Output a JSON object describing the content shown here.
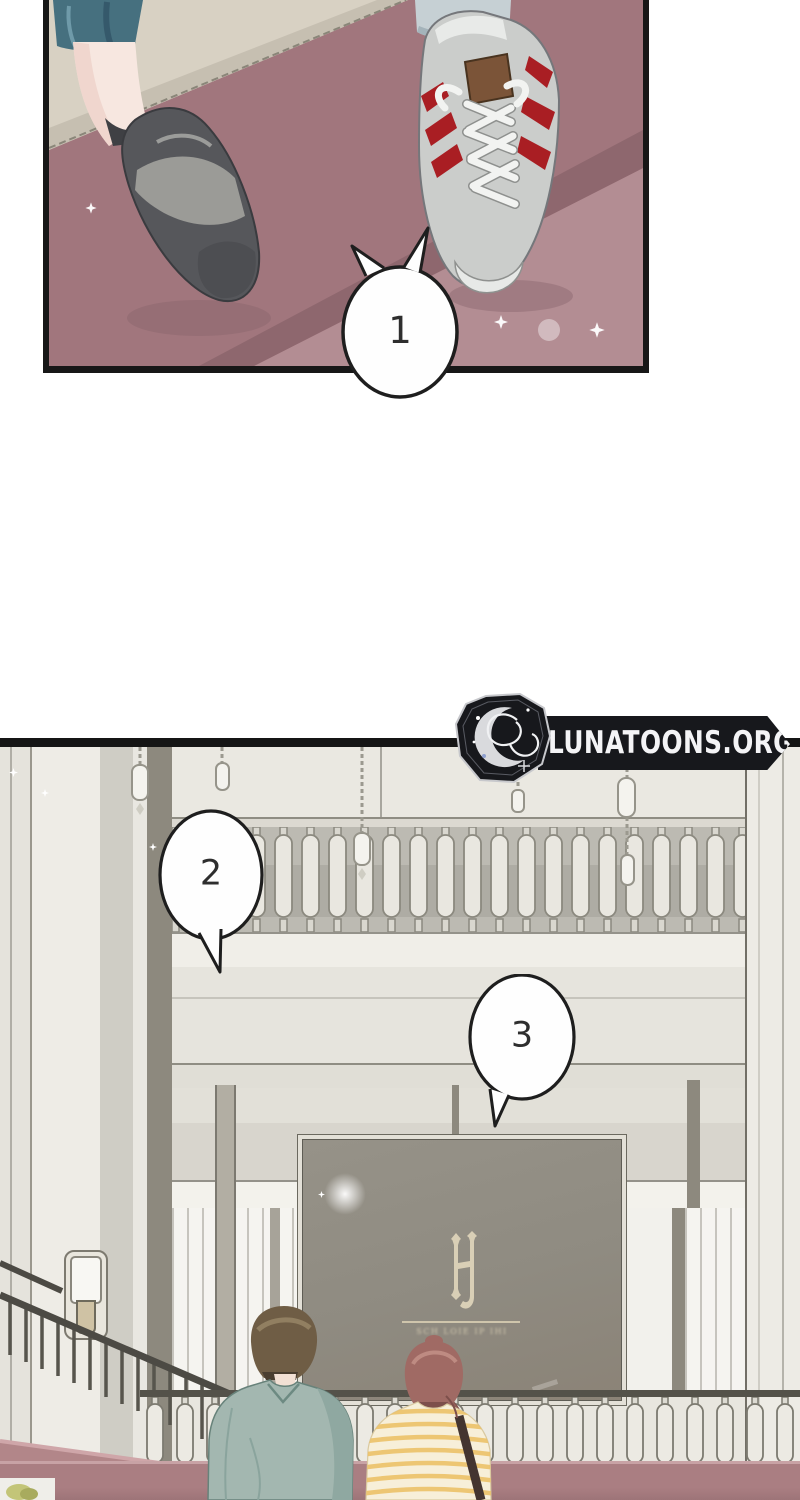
{
  "watermark": {
    "site": "LUNATOONS.ORG",
    "badge_icon": "crescent-moon-script-emblem"
  },
  "panel1": {
    "description": "close-up of two feet on mauve carpet",
    "bubble1": "1"
  },
  "panel2": {
    "description": "hotel lobby with balustrade, hanging lanterns, couple facing large sign",
    "bubble2": "2",
    "bubble3": "3",
    "sign": {
      "monogram": "HJ",
      "caption_illegible": "SCH LOIE IP IHI"
    }
  },
  "colors": {
    "floor_mauve": "#a1767d",
    "floor_beige": "#d8d1c3",
    "stripe_red": "#a91e23",
    "denim_blue": "#46707f",
    "sneaker_gray": "#cbcdcb",
    "lobby_wall": "#e8e6df",
    "sign_gray": "#8f8b81",
    "monogram_cream": "#d9cfb6",
    "parapet_rose": "#aa7e82",
    "jacket_teal": "#a3b7b0",
    "hair_brown": "#6f5d45",
    "hair_auburn": "#a06a64",
    "shirt_stripe_yellow": "#ecc168",
    "ink_outline": "#1e1e1e",
    "badge_black": "#17181c"
  }
}
